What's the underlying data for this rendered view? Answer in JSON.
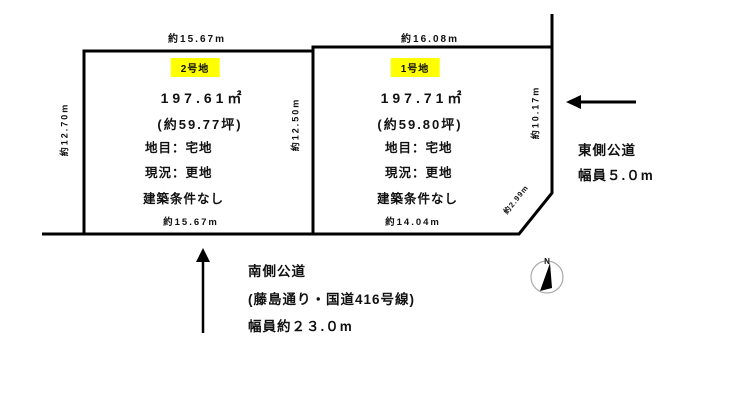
{
  "plots": [
    {
      "label": "2号地",
      "area": "197.61㎡",
      "area_tsubo": "(約59.77坪)",
      "land_category": "地目：宅地",
      "current_state": "現況：更地",
      "building_condition": "建築条件なし",
      "dim_top": "約15.67m",
      "dim_bottom": "約15.67m",
      "dim_left": "約12.70m",
      "dim_right": "約12.50m"
    },
    {
      "label": "1号地",
      "area": "197.71㎡",
      "area_tsubo": "(約59.80坪)",
      "land_category": "地目：宅地",
      "current_state": "現況：更地",
      "building_condition": "建築条件なし",
      "dim_top": "約16.08m",
      "dim_bottom": "約14.04m",
      "dim_right": "約10.17m",
      "dim_corner": "約2.99m"
    }
  ],
  "roads": {
    "south": {
      "name": "南側公道",
      "detail": "(藤島通り・国道416号線)",
      "width": "幅員約２３.０m"
    },
    "east": {
      "name": "東側公道",
      "width": "幅員５.０m"
    }
  },
  "compass": {
    "label": "N"
  },
  "colors": {
    "highlight": "#ffff00",
    "line": "#000000"
  }
}
